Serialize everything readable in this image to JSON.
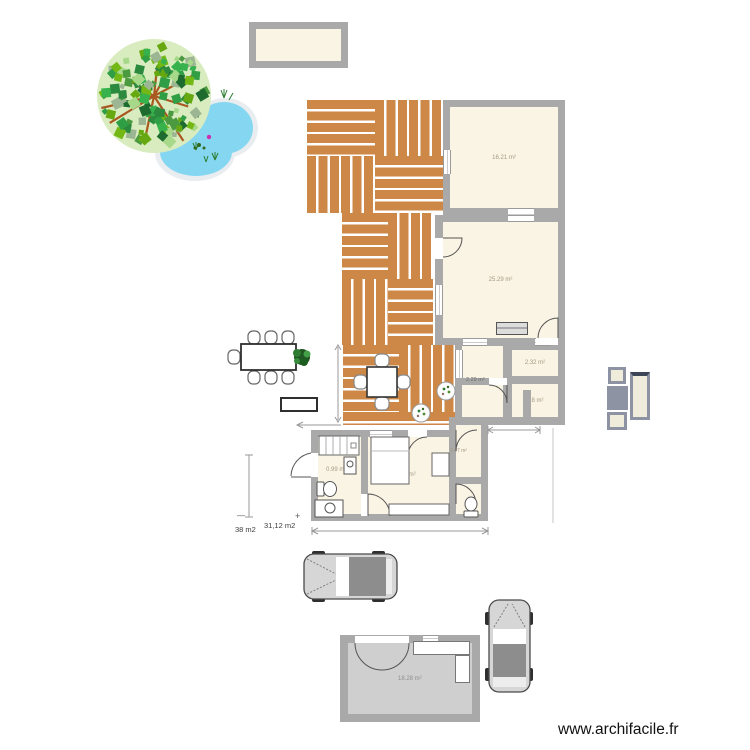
{
  "watermark": "www.archifacile.fr",
  "labels": {
    "room1_area": "16.21 m²",
    "room2_area": "25.29 m²",
    "wc_small_area": "2.32 m²",
    "hall_area": "2.29 m²",
    "bath_small_area": "4.8 m²",
    "bathroom_area": "0.99 m²",
    "bedroom_area": "13.27 m²",
    "closet_area": "0.97 m²",
    "garage_area": "18.28 m²",
    "dim_total_left": "38 m2",
    "dim_total_right": "31,12 m2",
    "tick_minus": "—",
    "tick_plus": "+"
  },
  "colors": {
    "wall": "#a9a9a9",
    "room_floor": "#faf4e4",
    "deck_plank": "#cd8746",
    "pond": "#85d7f1",
    "garage_floor": "#cfcfcf",
    "tree_leaf": "#2f9e44",
    "branch": "#a9591f"
  }
}
